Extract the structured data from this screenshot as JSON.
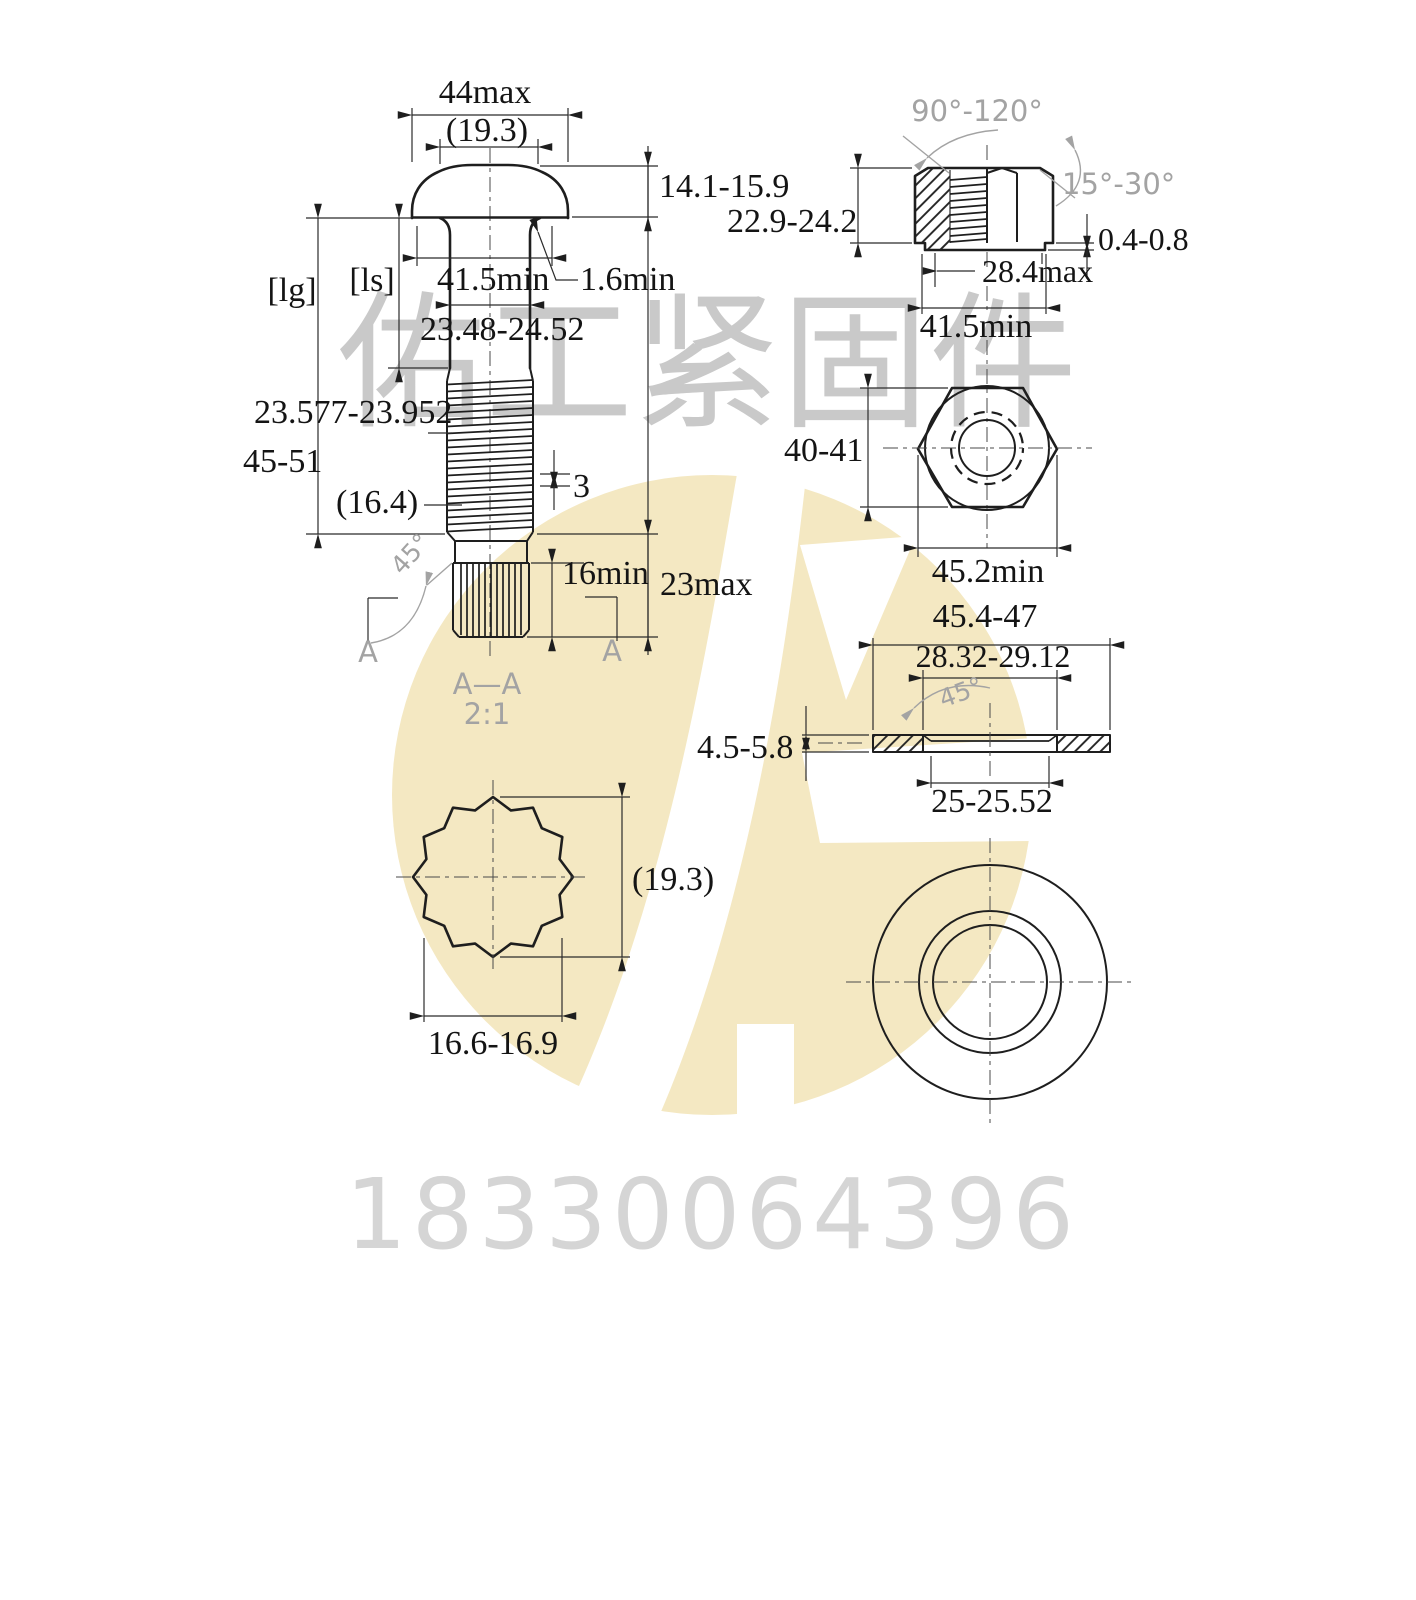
{
  "drawing": {
    "bolt": {
      "dim_head_dia": "44max",
      "dim_head_top_dia": "(19.3)",
      "dim_head_height": "14.1-15.9",
      "ref_grip": "[lg]",
      "ref_shank": "[ls]",
      "dim_bearing_dia": "41.5min",
      "dim_fillet": "1.6min",
      "dim_shank_dia": "23.48-24.52",
      "dim_thread_dia": "23.577-23.952",
      "dim_thread_length": "45-51",
      "dim_minor_ref": "(16.4)",
      "dim_pitch": "3",
      "angle_spline": "45°",
      "dim_spline_length": "16min",
      "dim_tip_length": "23max",
      "section_mark_left": "A",
      "section_mark_right": "A"
    },
    "section": {
      "title": "A—A",
      "scale": "2:1",
      "dim_major_dia": "(19.3)",
      "dim_across_flats": "16.6-16.9"
    },
    "nut": {
      "angle_countersink": "90°-120°",
      "angle_chamfer": "15°-30°",
      "dim_height": "22.9-24.2",
      "dim_washer_face_height": "0.4-0.8",
      "dim_washer_face_dia": "28.4max",
      "dim_bearing_dia": "41.5min",
      "dim_across_flats": "40-41",
      "dim_across_corners": "45.2min"
    },
    "washer": {
      "dim_outer_dia": "45.4-47",
      "dim_chamfer_dia": "28.32-29.12",
      "angle_chamfer": "45°",
      "dim_thickness": "4.5-5.8",
      "dim_hole_dia": "25-25.52"
    }
  },
  "watermark": {
    "company_name": "佑工紧固件",
    "phone": "18330064396"
  },
  "colors": {
    "line": "#1e1e1e",
    "annotation_gray": "#a3a3a3",
    "watermark_gray": "#c9c9c9",
    "phone_gray": "#d5d5d5",
    "logo_yellow": "#f4e8c2"
  }
}
